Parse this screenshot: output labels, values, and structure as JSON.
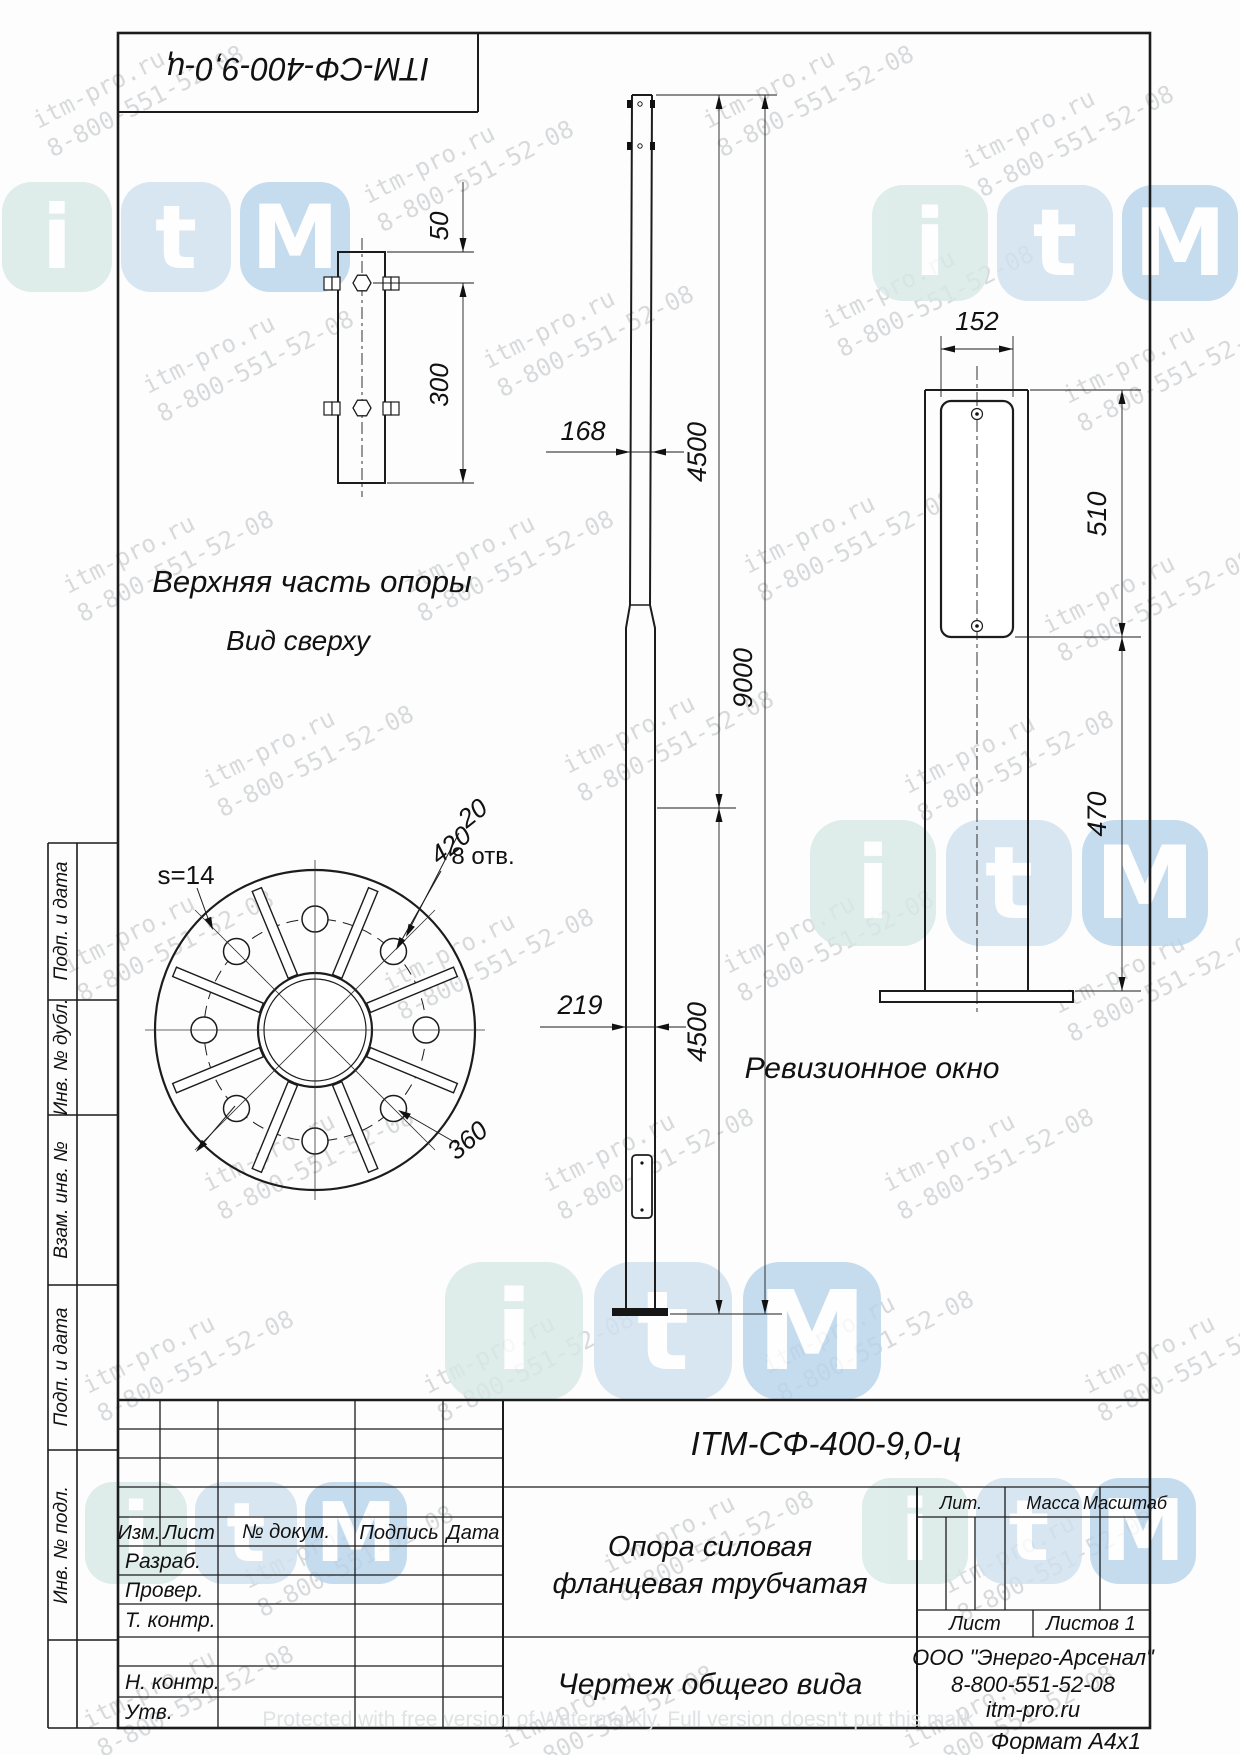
{
  "header": {
    "designation": "ITM-СФ-400-9,0-ц"
  },
  "views": {
    "top_part_label": "Верхняя часть опоры",
    "top_view_label": "Вид сверху",
    "revision_label": "Ревизионное окно"
  },
  "dims": {
    "d50": "50",
    "d300": "300",
    "s14": "s=14",
    "d420": "420",
    "d20": "20",
    "holes": "8 отв.",
    "d360": "360",
    "d168": "168",
    "d219": "219",
    "d4500a": "4500",
    "d9000": "9000",
    "d4500b": "4500",
    "d152": "152",
    "d510": "510",
    "d470": "470"
  },
  "side_strip": {
    "labels": [
      "Подп. и дата",
      "Инв. № дубл.",
      "Взам. инв. №",
      "Подп. и дата",
      "Инв. № подл."
    ]
  },
  "title_block": {
    "designation": "ITM-СФ-400-9,0-ц",
    "cols": {
      "izm": "Изм.",
      "list": "Лист",
      "doc": "№ докум.",
      "sign": "Подпись",
      "date": "Дата"
    },
    "rows": {
      "razrab": "Разраб.",
      "prover": "Провер.",
      "tkontr": "Т. контр.",
      "nkontr": "Н. контр.",
      "utv": "Утв."
    },
    "lit": "Лит.",
    "mass": "Масса",
    "scale": "Масштаб",
    "sheet": "Лист",
    "sheets": "Листов 1",
    "name_line1": "Опора силовая",
    "name_line2": "фланцевая  трубчатая",
    "doc_type": "Чертеж общего вида",
    "company": {
      "line1": "ООО \"Энерго-Арсенал\"",
      "line2": "8-800-551-52-08",
      "line3": "itm-pro.ru"
    },
    "format": "Формат  А4х1"
  },
  "watermark": {
    "line1": "itm-pro.ru",
    "line2": "8-800-551-52-08",
    "protected_text": "Protected with free version of Watermarkly. Full version doesn't put this mark",
    "color": "#8f969b"
  },
  "logo": {
    "letters": [
      "i",
      "t",
      "M"
    ],
    "tile_colors": [
      "#d7e8e6",
      "#cfe1ef",
      "#b8d4ec"
    ]
  }
}
